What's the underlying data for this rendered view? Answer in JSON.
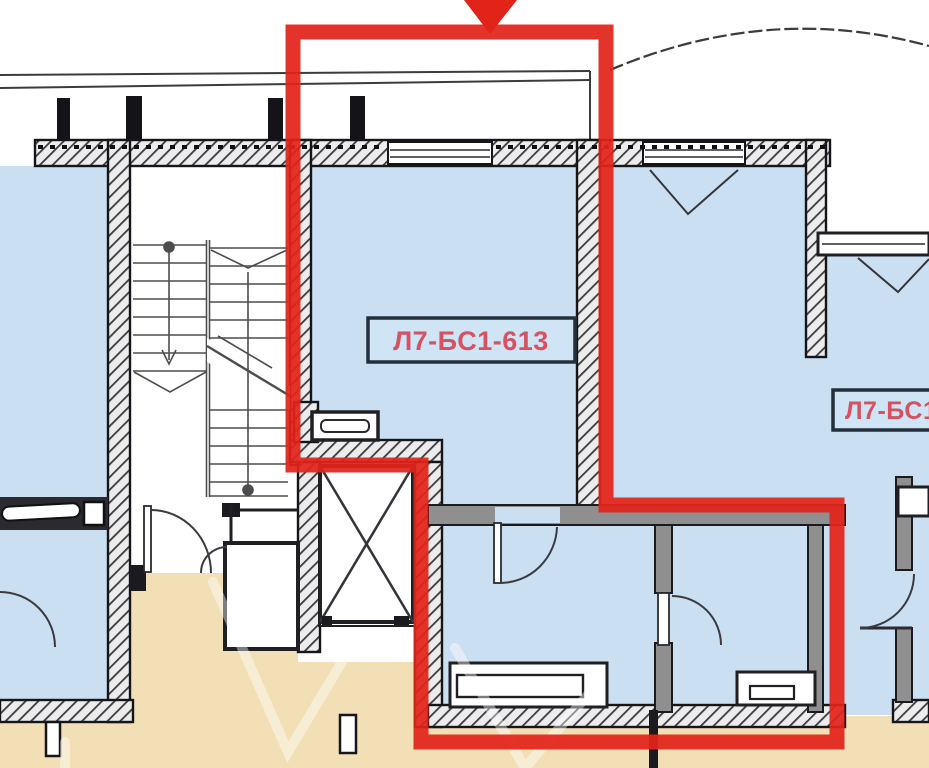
{
  "plan": {
    "type": "apartment-floor-plan",
    "highlighted_unit": {
      "label": "Л7-БС1-613"
    },
    "adjacent_unit": {
      "label": "Л7-БС1-6"
    },
    "colors": {
      "highlight": "#e2231a",
      "room_fill": "#cbdff2",
      "corridor_fill": "#f2dfb6",
      "wall": "#1b1b1f",
      "label_text": "#d65260",
      "label_border": "#232f3a",
      "label_fill": "#cfe4f5"
    }
  }
}
